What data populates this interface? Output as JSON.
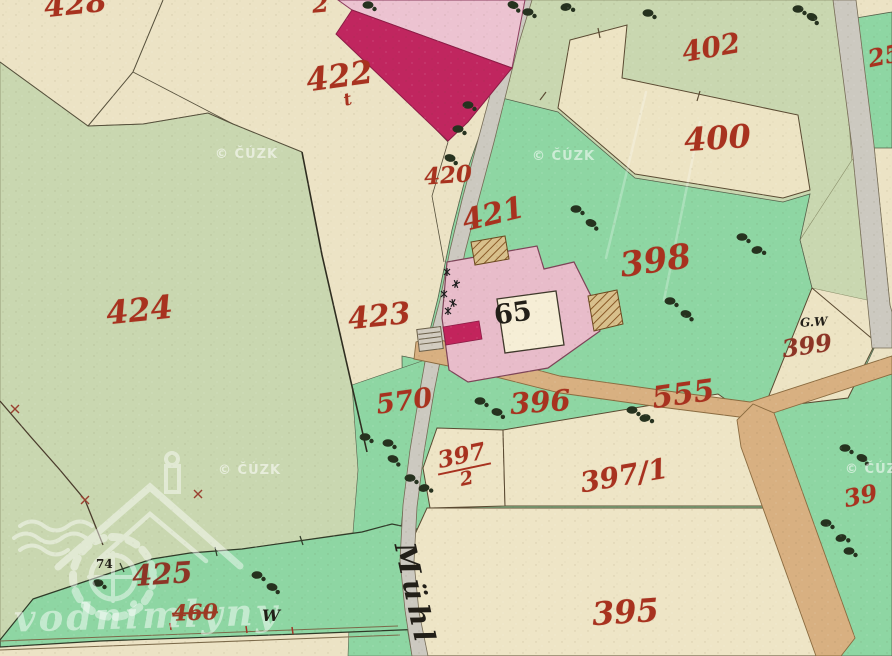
{
  "view": {
    "description": "historical hand-coloured cadastral map tile",
    "width": 892,
    "height": 656
  },
  "watermarks": {
    "copyright": "© ČÚZK",
    "logo_text": "vodnimlyny"
  },
  "parcel_labels": [
    {
      "number": "428"
    },
    {
      "number": "2"
    },
    {
      "number": "422"
    },
    {
      "number": "t"
    },
    {
      "number": "421"
    },
    {
      "number": "420"
    },
    {
      "number": "402"
    },
    {
      "number": "400"
    },
    {
      "number": "25"
    },
    {
      "number": "398"
    },
    {
      "number": "424"
    },
    {
      "number": "423"
    },
    {
      "number": "570"
    },
    {
      "number": "396"
    },
    {
      "number": "555"
    },
    {
      "number": "399"
    },
    {
      "number": "397"
    },
    {
      "number": "2"
    },
    {
      "number": "397/1"
    },
    {
      "number": "39"
    },
    {
      "number": "395"
    },
    {
      "number": "425"
    },
    {
      "number": "460"
    }
  ],
  "annotations": [
    {
      "text": "65"
    },
    {
      "text": "G.W"
    },
    {
      "text": "74"
    },
    {
      "text": "W"
    },
    {
      "text": "Mühl"
    }
  ],
  "colors": {
    "parcel_number_red": "#a8321f",
    "meadow_green": "#8ed6a3",
    "pale_green": "#c9d7b0",
    "field_cream": "#ece3c5",
    "road_gray": "#ccc9c0",
    "road_tan": "#d8b081",
    "building_pink": "#e8bcca",
    "building_crimson": "#c0265f"
  }
}
